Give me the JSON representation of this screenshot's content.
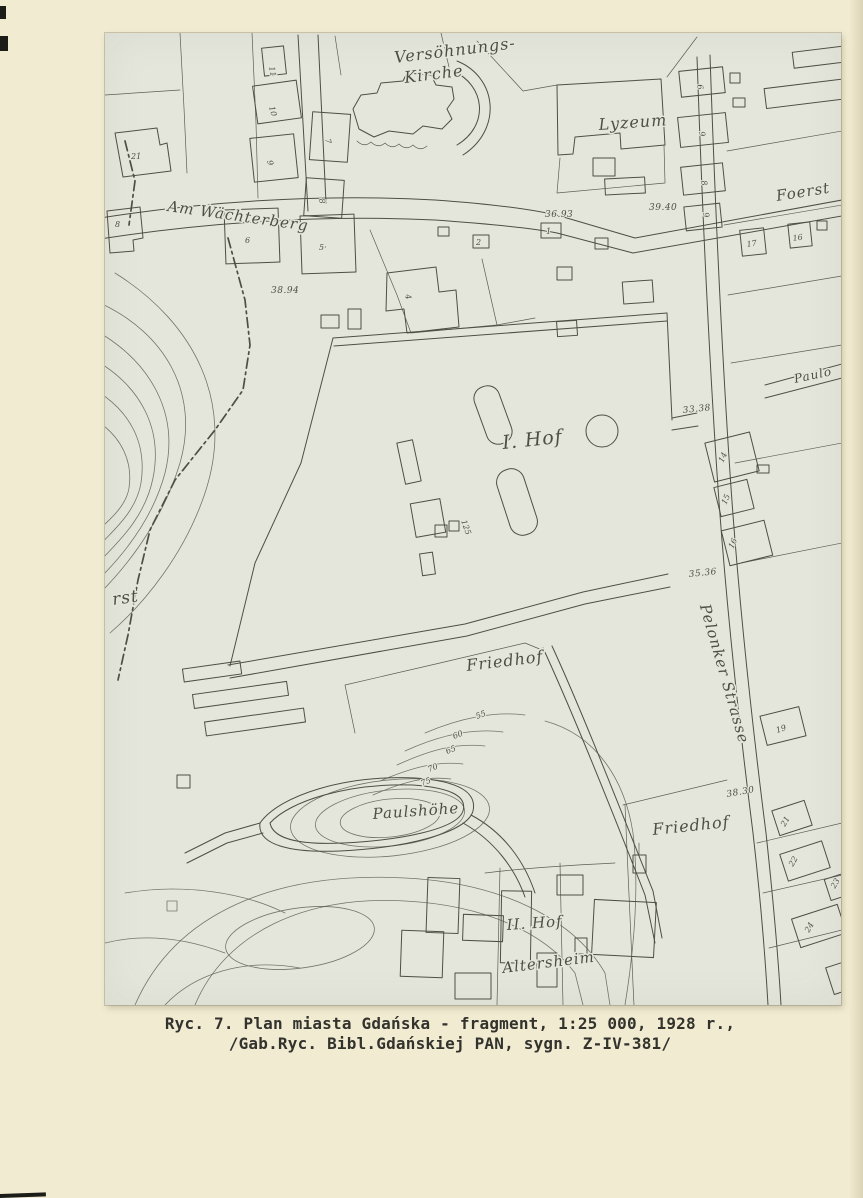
{
  "colors": {
    "page_bg": "#f1ebd1",
    "map_paper": "#e4e6dc",
    "ink": "#4e4e45",
    "caption_text": "#33332e"
  },
  "caption": {
    "line1": "Ryc. 7. Plan miasta Gdańska - fragment, 1:25 000, 1928 r.,",
    "line2": "/Gab.Ryc. Bibl.Gdańskiej PAN, sygn. Z-IV-381/"
  },
  "map": {
    "labels": {
      "kirche1": "Versöhnungs-",
      "kirche2": "Kirche",
      "lyzeum": "Lyzeum",
      "wachterberg": "Am Wächterberg",
      "foerst": "Foerst",
      "pelonker": "Pelonker Strasse",
      "paulo": "Paulo",
      "hof1": "I. Hof",
      "friedhof1": "Friedhof",
      "friedhof2": "Friedhof",
      "paulshoehe": "Paulshöhe",
      "hof2": "II. Hof",
      "altersheim": "Altersheim",
      "forst_cut": "rst"
    },
    "elevations": {
      "a": "36.93",
      "b": "38.94",
      "c": "39.40",
      "d": "33.38",
      "e": "35.36",
      "f": "38.30"
    },
    "contours": {
      "c55": "55",
      "c60": "60",
      "c65": "65",
      "c70": "70",
      "c75": "75"
    },
    "houses": {
      "n21": "21",
      "n11": "11",
      "n10": "10",
      "n9": "9",
      "n7": "7",
      "n8a": "8",
      "n8": "8",
      "n6": "6",
      "n5": "5·",
      "n4": "4",
      "n2": "2",
      "n1": "1",
      "e6": "6",
      "e9": "9",
      "e8": "8",
      "e9b": "9",
      "n17": "17",
      "n16": "16",
      "n14": "14",
      "n15": "15",
      "n16b": "16",
      "n19": "19",
      "n21b": "21",
      "n22": "22",
      "n23": "23",
      "n24": "24",
      "n125": "125"
    }
  }
}
